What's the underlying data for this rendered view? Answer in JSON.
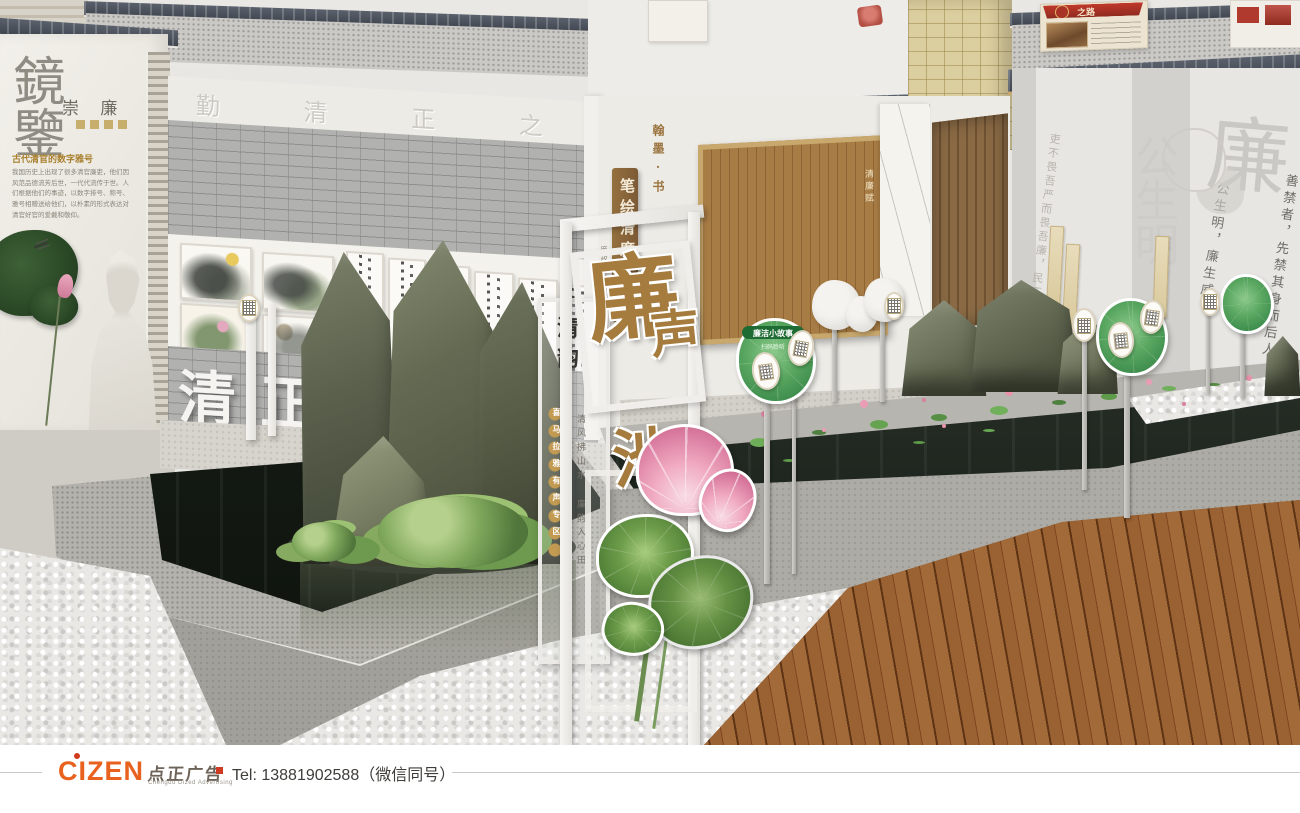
{
  "footer": {
    "logo": "CIZEN",
    "logo_cn": "点正广告",
    "logo_en": "Chengdu Dized Advertising",
    "tel": "Tel: 13881902588（微信同号）"
  },
  "scene": {
    "mirror_panel": {
      "big_chars": "鏡鑒",
      "side_chars": "崇 廉",
      "heading": "古代清官的数字雅号",
      "body": "我国历史上出现了很多清官廉吏，他们因风范品德流芳后世，一代代流传于世。人们根据他们的事迹，以数字排号、称号、雅号相赠送给他们，以朴素的形式表达对清官好官的爱戴和敬仰。"
    },
    "frieze_chars": "勤 清 正 之 风",
    "gallery_relief": "清正廉洁",
    "brush_wall": {
      "seal_chars": "翰墨·书",
      "plaque": "笔绘清廉",
      "plaque_sub": "廉政书画作品",
      "screen_title": "清廉赋"
    },
    "portal": {
      "title_chars": [
        "廉",
        "声",
        "池"
      ],
      "glass_title": "清韵",
      "glass_discs": "喜马拉雅有声专区",
      "glass_phrase": "清风拂山水 廉韵入心田"
    },
    "right_wall": {
      "watermark_big": "公生明",
      "watermark_lian": "廉",
      "watermark_gong": "公",
      "quote_1": "公生明，廉生威。",
      "quote_2": "善禁者，先禁其身而后人。",
      "quote_3": "吏不畏吾严而畏吾廉，民不服吾能而服吾公。"
    },
    "story_sign": {
      "title": "廉洁小故事",
      "sub": "扫码聆听"
    },
    "upper": {
      "red_banner": "之路"
    }
  }
}
